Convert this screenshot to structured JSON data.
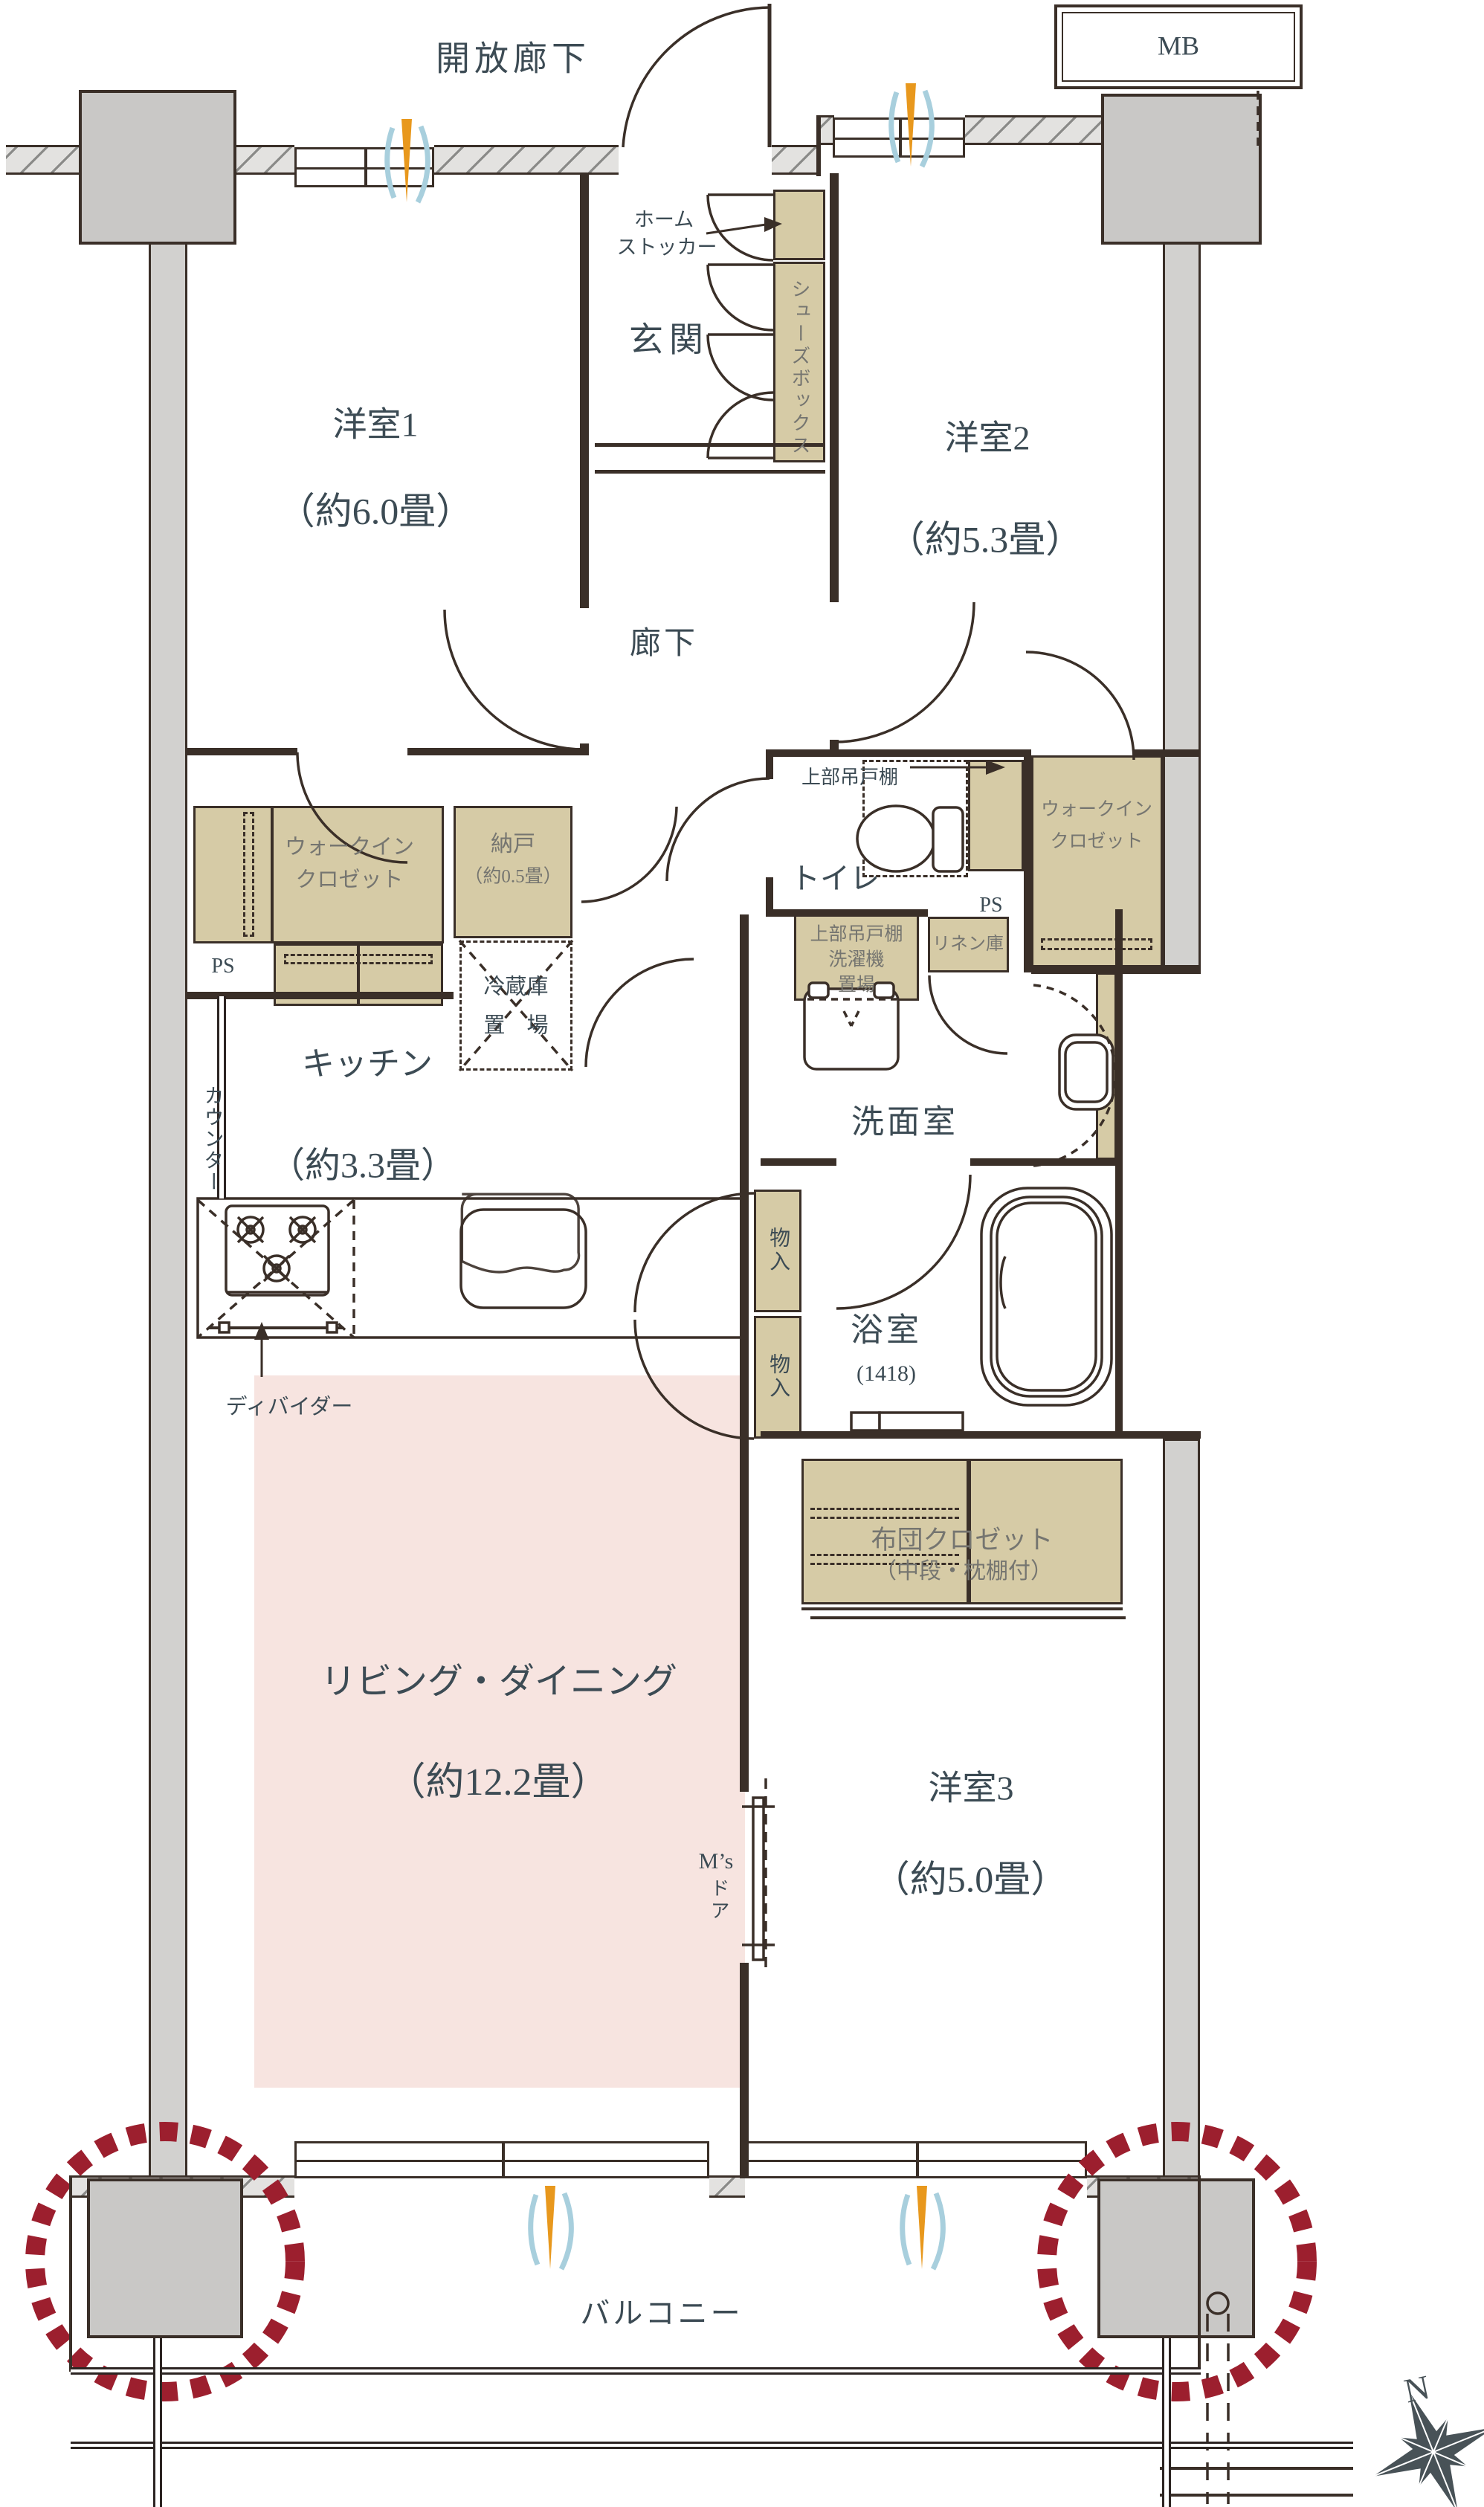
{
  "colors": {
    "label_dark": "#3c4b54",
    "label_gray": "#757570",
    "wall": "#3a2f28",
    "cabinet_tan": "#d6cba6",
    "living_pink": "#f7e4e0",
    "pillar_gray": "#c9c8c6",
    "highlight_red": "#9c1f2e",
    "vent_orange": "#e8981d",
    "vent_blue": "#a8cfdd",
    "compass": "#485257"
  },
  "outside": {
    "open_corridor": "開放廊下",
    "mb": "MB",
    "balcony": "バルコニー",
    "north": "N"
  },
  "entrance": {
    "name": "玄関",
    "home_stocker_line1": "ホーム",
    "home_stocker_line2": "ストッカー",
    "shoe_box": "シューズボックス"
  },
  "rooms": {
    "western1": {
      "name": "洋室1",
      "size": "（約6.0畳）"
    },
    "western2": {
      "name": "洋室2",
      "size": "（約5.3畳）"
    },
    "western3": {
      "name": "洋室3",
      "size": "（約5.0畳）"
    },
    "living_dining": {
      "name": "リビング・ダイニング",
      "size": "（約12.2畳）"
    },
    "kitchen": {
      "name": "キッチン",
      "size": "（約3.3畳）",
      "counter": "カウンター",
      "divider": "ディバイダー",
      "fridge_line1": "冷蔵庫",
      "fridge_line2": "置　場"
    },
    "hall": {
      "name": "廊下"
    },
    "toilet": {
      "name": "トイレ",
      "upper_cabinet": "上部吊戸棚",
      "ps": "PS"
    },
    "washroom": {
      "name": "洗面室",
      "washer_line1": "上部吊戸棚",
      "washer_line2": "洗濯機",
      "washer_line3": "置場",
      "linen": "リネン庫"
    },
    "bath": {
      "name": "浴室",
      "size": "(1418)"
    }
  },
  "storage": {
    "wic_left_line1": "ウォークイン",
    "wic_left_line2": "クロゼット",
    "wic_right_line1": "ウォークイン",
    "wic_right_line2": "クロゼット",
    "nando": "納戸",
    "nando_size": "（約0.5畳）",
    "futon_line1": "布団クロゼット",
    "futon_line2": "（中段・枕棚付）",
    "mono1": "物入",
    "mono2": "物入",
    "ps_left": "PS"
  },
  "ms_door": {
    "line1": "M’s",
    "line2": "ドア"
  }
}
